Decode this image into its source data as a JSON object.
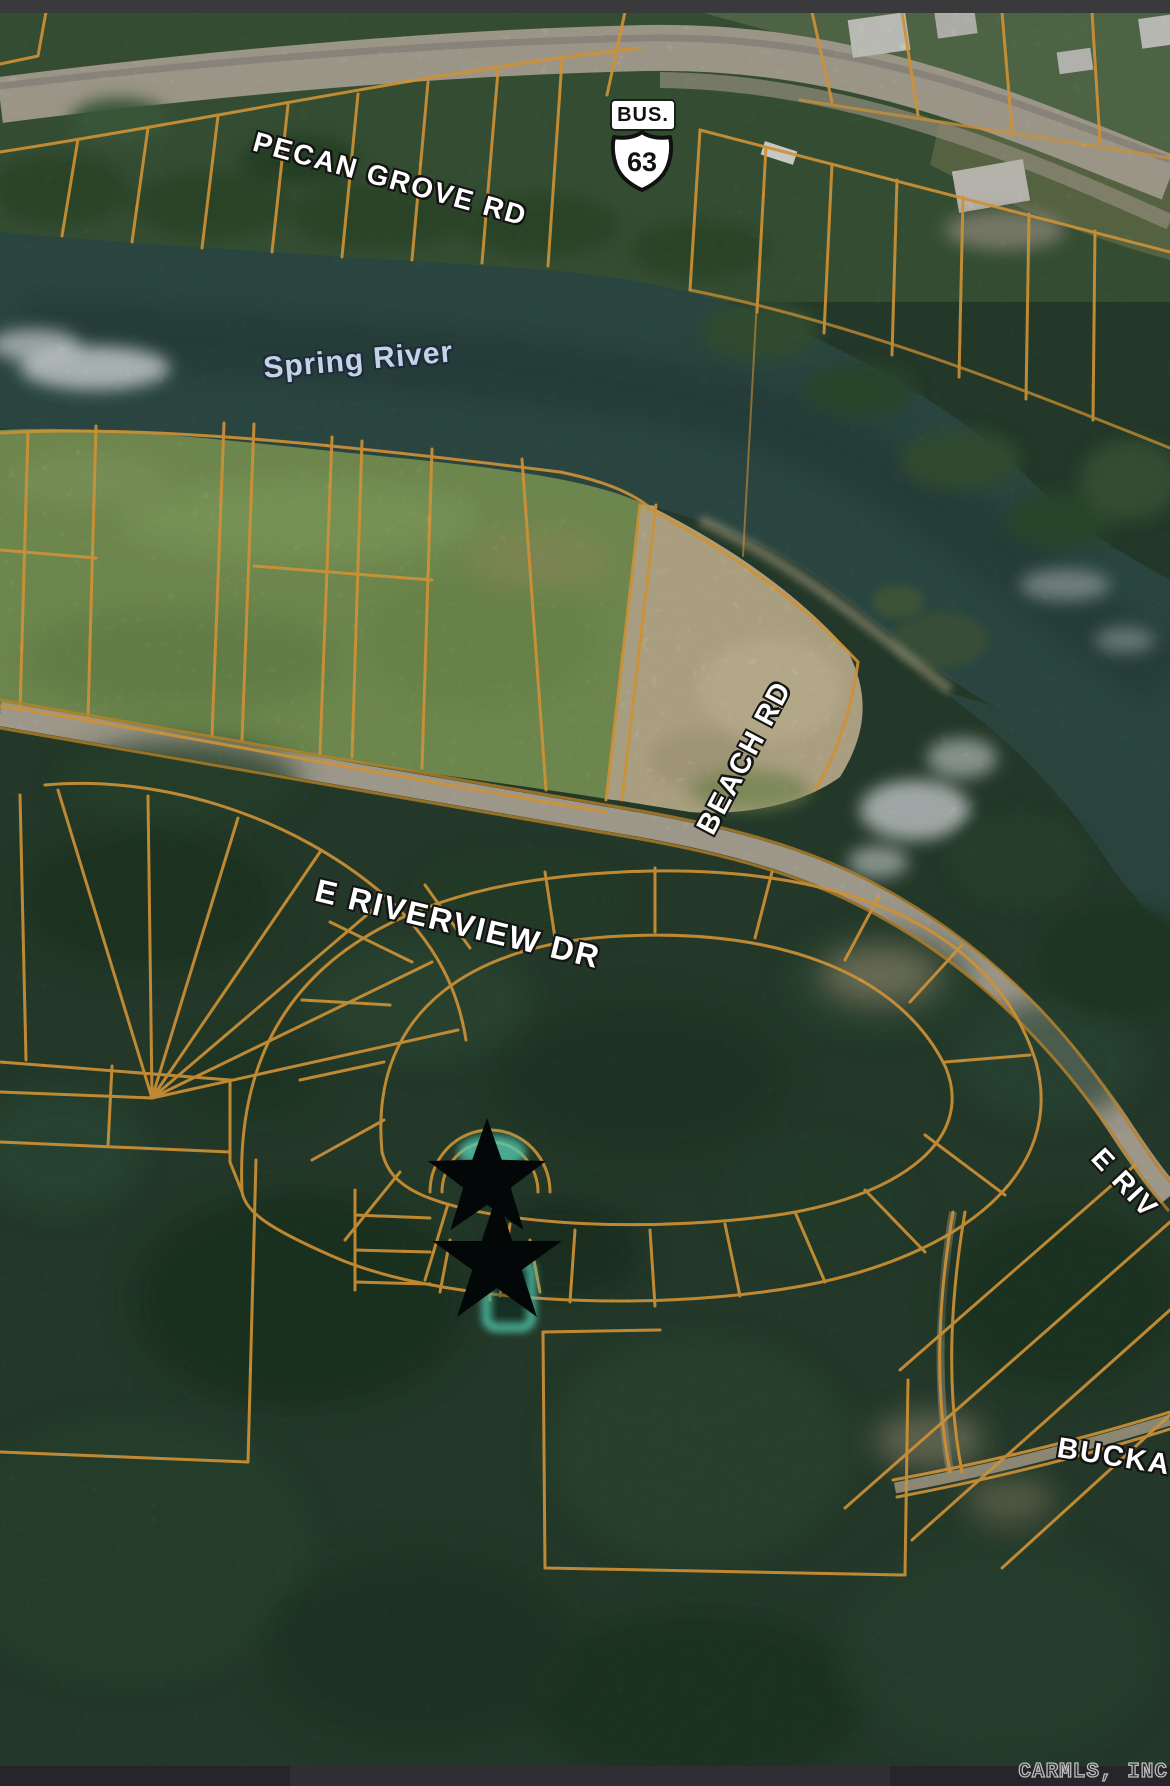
{
  "map": {
    "type": "satellite-parcel-map",
    "labels": {
      "pecan_grove_rd": "PECAN GROVE RD",
      "bus": "BUS.",
      "route_number": "63",
      "spring_river": "Spring River",
      "beach_rd": "BEACH RD",
      "e_riverview_dr": "E RIVERVIEW DR",
      "e_riverview_dr_right": "E RIV",
      "buckaroo_partial": "BUCKA",
      "watermark": "CARMLS, INC"
    },
    "markers": [
      {
        "name": "star-marker",
        "shape": "star"
      },
      {
        "name": "star-marker",
        "shape": "star"
      }
    ],
    "highlighted_parcel": {
      "present": true,
      "color": "#5fe7c9"
    }
  },
  "colors": {
    "top_bar": "#3a3a3c",
    "bottom_bar": "#26262a",
    "bottom_bar_alt": "#2e2e33",
    "parcel_line": "#f0a93f",
    "parcel_line_dim": "#d9982f",
    "highlight": "#5fe7c9",
    "star": "#05090a",
    "water": "#32514b",
    "field": "#7f9c5a",
    "forest": "#2a4230",
    "road": "#b7b0a0",
    "sand": "#c6b995",
    "label_text": "#ffffff",
    "label_outline": "#141414",
    "water_label": "#c3d4e9",
    "watermark": "#bcbcbc"
  }
}
